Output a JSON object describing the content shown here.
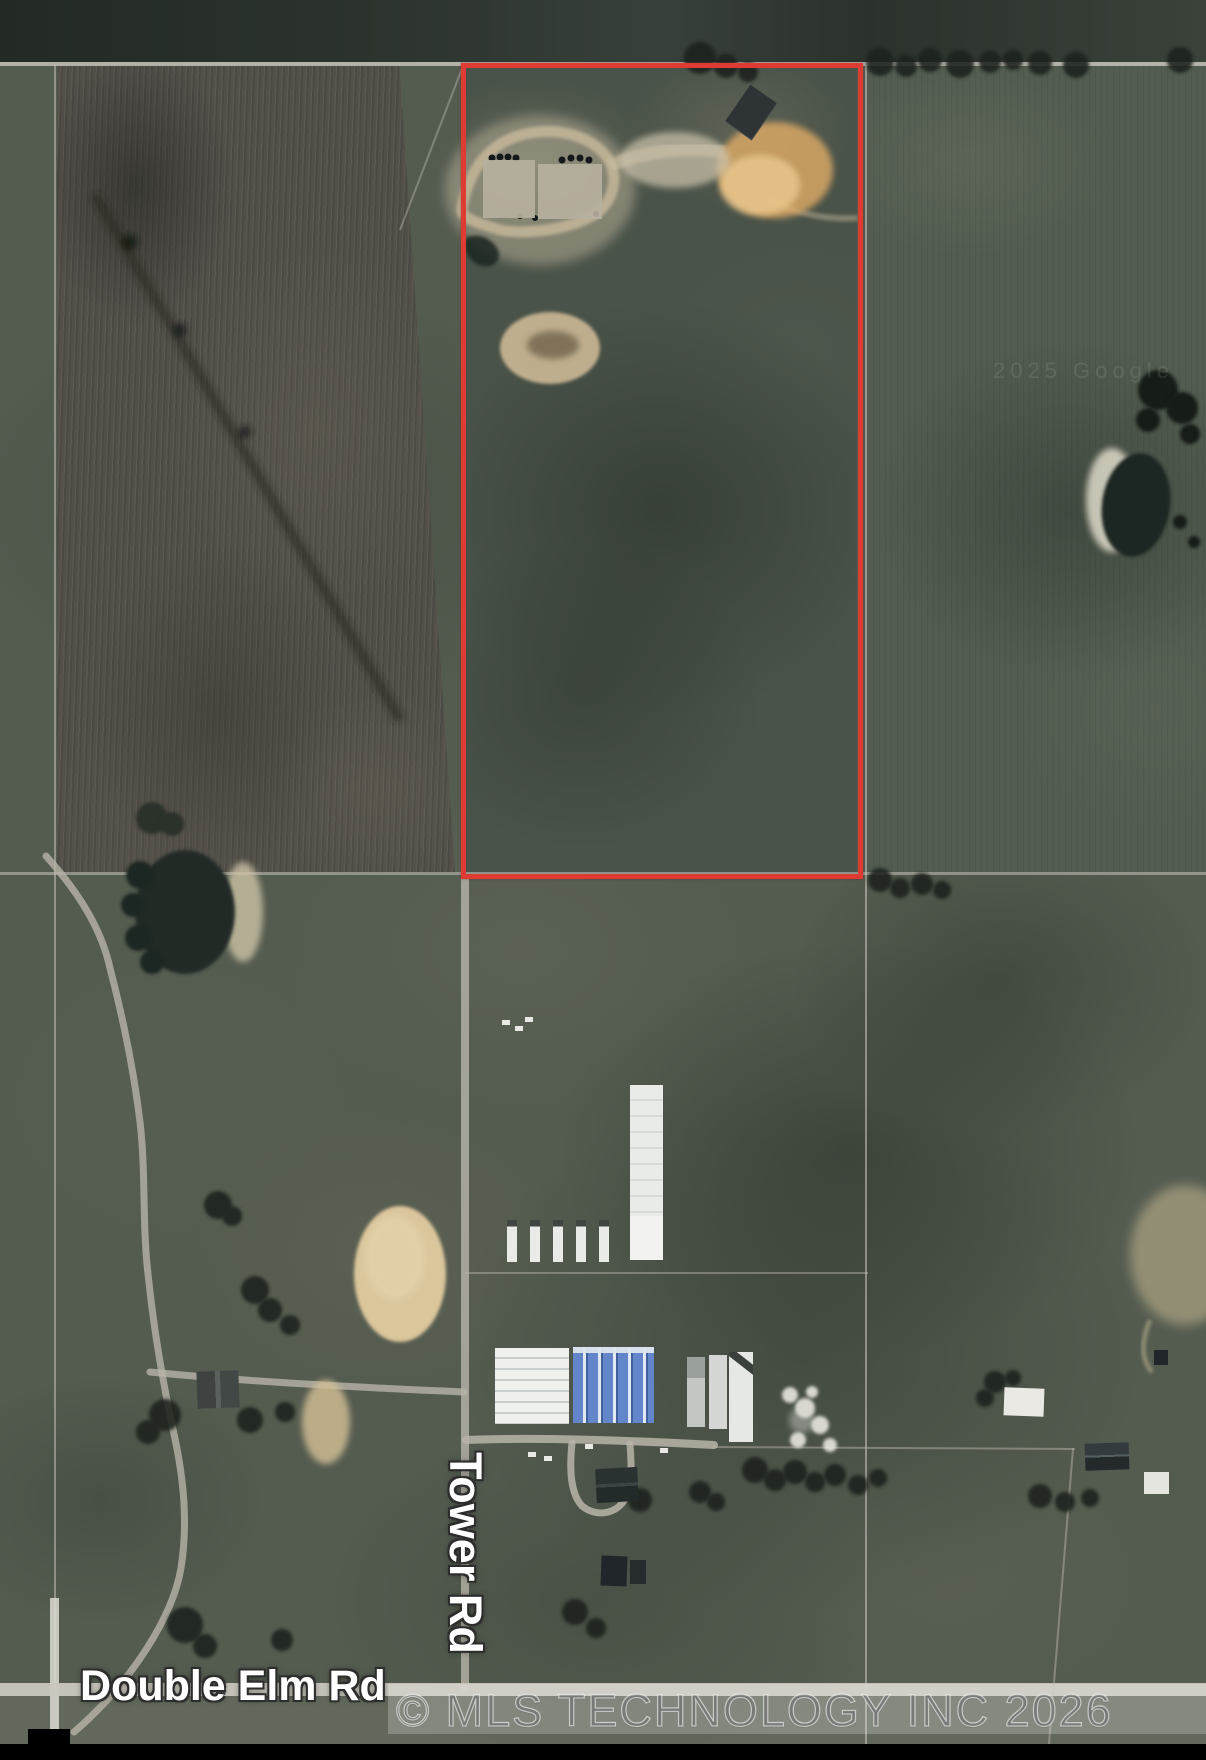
{
  "labels": {
    "tower_rd": "Tower Rd",
    "double_elm_rd": "Double Elm Rd"
  },
  "watermark": {
    "text": "© MLS TECHNOLOGY INC 2026"
  },
  "credit": {
    "text": "2025 Google"
  },
  "colors": {
    "boundary": "#de3b33",
    "road": "#cac7bf",
    "road_label_fill": "#ffffff",
    "road_label_outline": "#2d2d2d",
    "water": "#1f2822",
    "sand": "#dbc69c",
    "dirt_orange": "#e0ac66",
    "barn_blue": "#6286c9",
    "letterbox": "#000000"
  },
  "features": [
    "property-boundary",
    "tower-road",
    "double-elm-road",
    "tilled-field",
    "well-pad-site",
    "stock-pond",
    "dark-barn",
    "left-pond",
    "right-pond",
    "sand-arena",
    "long-white-building",
    "trailer-row",
    "white-barn",
    "blue-barn",
    "homestead",
    "watermark-bar"
  ]
}
